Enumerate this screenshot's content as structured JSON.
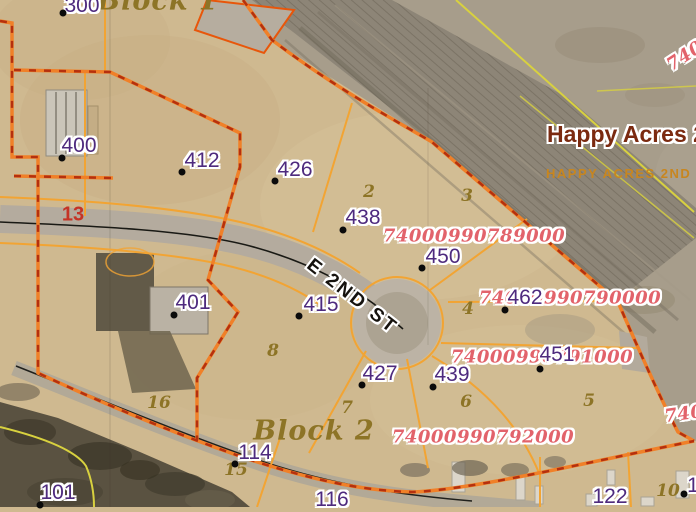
{
  "map_labels": {
    "street_name": "E 2ND ST",
    "subdivision_title": "Happy Acres 2n",
    "subdivision_subtitle": "HAPPY ACRES 2ND ADDN",
    "highway_number": "13",
    "block_labels": [
      {
        "text": "Block 1"
      },
      {
        "text": "Block 2"
      }
    ],
    "addresses": [
      {
        "text": "300"
      },
      {
        "text": "400"
      },
      {
        "text": "412"
      },
      {
        "text": "426"
      },
      {
        "text": "438"
      },
      {
        "text": "450"
      },
      {
        "text": "462"
      },
      {
        "text": "451"
      },
      {
        "text": "401"
      },
      {
        "text": "415"
      },
      {
        "text": "427"
      },
      {
        "text": "439"
      },
      {
        "text": "114"
      },
      {
        "text": "116"
      },
      {
        "text": "101"
      },
      {
        "text": "122"
      },
      {
        "text": "1"
      }
    ],
    "lot_numbers": [
      {
        "text": "2"
      },
      {
        "text": "3"
      },
      {
        "text": "4"
      },
      {
        "text": "5"
      },
      {
        "text": "6"
      },
      {
        "text": "7"
      },
      {
        "text": "8"
      },
      {
        "text": "16"
      },
      {
        "text": "15"
      },
      {
        "text": "10"
      }
    ],
    "parcel_ids": [
      {
        "text": "74000990789000"
      },
      {
        "text": "74000990790000"
      },
      {
        "text": "74000990791000"
      },
      {
        "text": "74000990792000"
      },
      {
        "text": "740"
      },
      {
        "text": "740"
      }
    ],
    "colors": {
      "subdivision_boundary": "#e8560a",
      "boundary_dash": "#b5300e",
      "lot_line": "#f2a433",
      "survey_line_yellow": "#d8d13f",
      "address_label": "#4e2a7e",
      "parcel_id_label": "#e2636b",
      "lot_number_label": "#8d7426",
      "highway_label": "#c53326",
      "subdivision_title": "#7b2a10",
      "subdivision_subtitle": "#c8861f"
    }
  }
}
